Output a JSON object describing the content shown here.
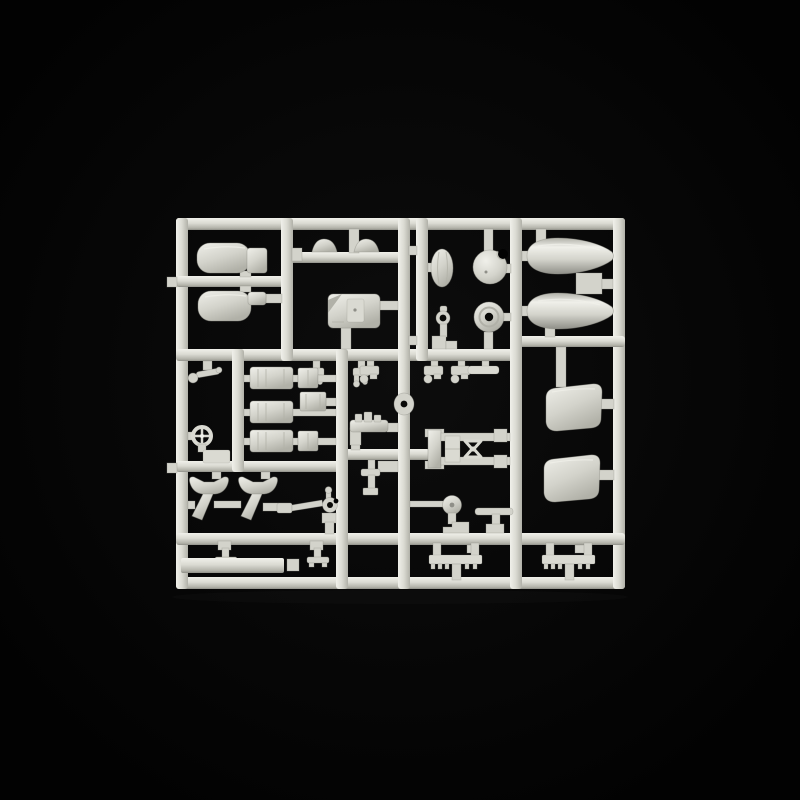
{
  "meta": {
    "type": "product-photograph",
    "description": "Unpainted light grey injection-moulded model kit sprue (parts tree) photographed on a plain black background",
    "alt": "Plastic model kit sprue with unassembled grey parts on a black background"
  },
  "colors": {
    "background": "#020202",
    "vignette": "#0d0d0d",
    "plastic": "#d3d3cb",
    "plastic_hi": "#f0f0ea",
    "plastic_mid": "#dadad2",
    "plastic_lo": "#b1b1a8",
    "plastic_deep": "#8f8f88",
    "hole": "#0a0a08",
    "reflection": "#222222"
  },
  "sprue": {
    "frame": {
      "rails": [
        "rail-top",
        "rail-bottom",
        "rail-left",
        "rail-right",
        "rail-h1",
        "rail-h2",
        "rail-h3",
        "rail-bomb-shelf",
        "rail-panel-shelf",
        "rail-dome-branch",
        "rail-link-branch",
        "rail-v1",
        "rail-v2",
        "rail-v2b",
        "rail-v3",
        "rail-v-cylinders",
        "rail-v-mid"
      ],
      "outer_tabs": [
        "left-tab-upper",
        "left-tab-lower"
      ],
      "gates": "small rectangular sprue gates joining parts to rails"
    },
    "parts": [
      "rounded-panel-upper",
      "rounded-panel-lower",
      "blister-dome-left",
      "blister-dome-right",
      "cockpit-tub",
      "teardrop-fairing",
      "ball-turret",
      "ring-eyelet",
      "wheel-disc",
      "drop-tank-upper",
      "drop-tank-lower",
      "pipe-valve-left",
      "pipe-valve-right",
      "bell-crank-lever",
      "spoked-handwheel",
      "engine-cylinder-top",
      "engine-cylinder-middle",
      "engine-cylinder-bottom",
      "junction-box",
      "caliper-bracket-a",
      "caliper-bracket-b",
      "caliper-bracket-c",
      "flat-bracket",
      "rail-grommet",
      "exhaust-elbow",
      "drain-valve",
      "linkage-rod-assembly",
      "cowl-panel-upper",
      "cowl-panel-lower",
      "funnel-seat-left",
      "funnel-seat-right",
      "hook-control-arm",
      "t-stand-left",
      "t-stand-right",
      "flat-strip-plate",
      "pulley-wheel",
      "tiller-bar",
      "tread-comb-center",
      "tread-comb-right"
    ]
  }
}
